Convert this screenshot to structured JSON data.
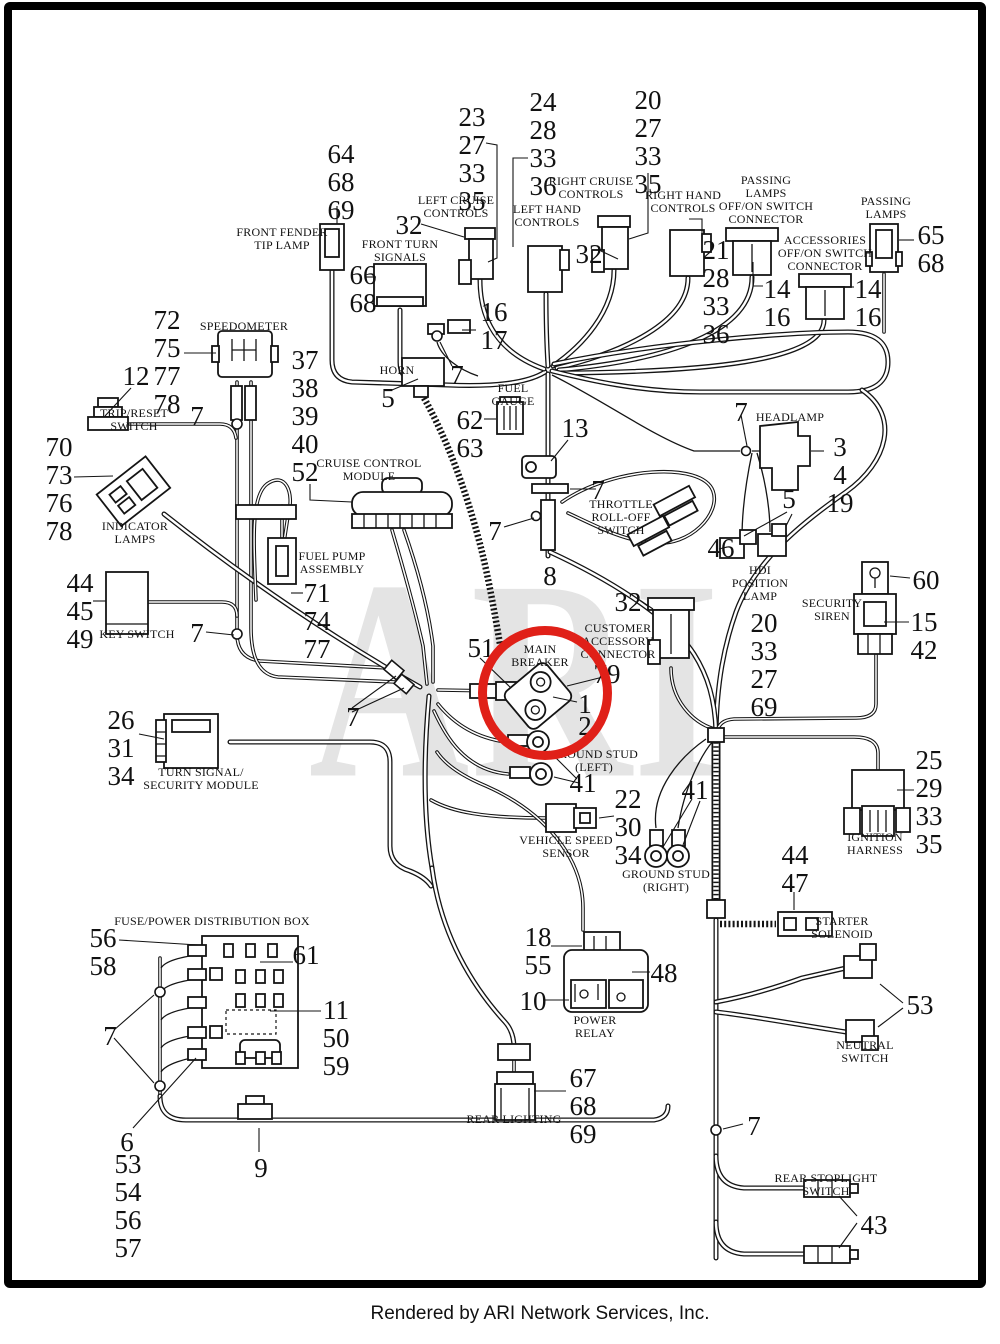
{
  "page": {
    "watermark": "ARI",
    "footer_credit": "Rendered by ARI Network Services, Inc.",
    "highlight_color": "#e02018",
    "line_color": "#141414"
  },
  "labels": {
    "front_fender_tip_lamp": "FRONT FENDER\nTIP LAMP",
    "front_turn_signals": "FRONT TURN\nSIGNALS",
    "left_cruise_controls": "LEFT CRUISE\nCONTROLS",
    "left_hand_controls": "LEFT HAND\nCONTROLS",
    "right_cruise_controls": "RIGHT CRUISE\nCONTROLS",
    "right_hand_controls": "RIGHT HAND\nCONTROLS",
    "passing_lamps_offon_switch_connector": "PASSING\nLAMPS\nOFF/ON SWITCH\nCONNECTOR",
    "accessories_offon_switch_connector": "ACCESSORIES\nOFF/ON SWITCH\nCONNECTOR",
    "passing_lamps": "PASSING\nLAMPS",
    "speedometer": "SPEEDOMETER",
    "trip_reset_switch": "TRIP/RESET\nSWITCH",
    "horn": "HORN",
    "fuel_gauge": "FUEL\nGAUGE",
    "cruise_control_module": "CRUISE CONTROL\nMODULE",
    "throttle_roll_off_switch": "THROTTLE\nROLL-OFF\nSWITCH",
    "headlamp": "HEADLAMP",
    "hdi_position_lamp": "HDI\nPOSITION\nLAMP",
    "security_siren": "SECURITY\nSIREN",
    "key_switch": "KEY SWITCH",
    "indicator_lamps": "INDICATOR\nLAMPS",
    "fuel_pump_assembly": "FUEL PUMP\nASSEMBLY",
    "customer_accessory_connector": "CUSTOMER\nACCESSORY\nCONNECTOR",
    "main_breaker": "MAIN\nBREAKER",
    "ground_stud_left": "GROUND STUD\n(LEFT)",
    "turn_signal_security_module": "TURN SIGNAL/\nSECURITY MODULE",
    "vehicle_speed_sensor": "VEHICLE SPEED\nSENSOR",
    "ground_stud_right": "GROUND STUD\n(RIGHT)",
    "ignition_harness": "IGNITION\nHARNESS",
    "starter_solenoid": "STARTER\nSOLENOID",
    "fuse_power_distribution_box": "FUSE/POWER DISTRIBUTION BOX",
    "power_relay": "POWER\nRELAY",
    "neutral_switch": "NEUTRAL\nSWITCH",
    "rear_lighting": "REAR LIGHTING",
    "rear_stoplight_switch": "REAR STOPLIGHT\nSWITCH"
  },
  "callouts": {
    "front_fender_tip_lamp": "64\n68\n69",
    "left_cruise": "23\n27\n33\n35",
    "left_hand": "24\n28\n33\n36",
    "right_cruise": "20\n27\n33\n35",
    "n32_left_cruise": "32",
    "n32_right_cruise": "32",
    "right_hand": "21\n28\n33\n36",
    "passing_offon": "14\n16",
    "accessories_offon": "14\n16",
    "passing_lamps": "65\n68",
    "front_turn_signals": "66\n68",
    "n16_17": "16\n17",
    "speedometer": "72\n75\n77\n78",
    "n12_trip_reset": "12",
    "n7_trip": "7",
    "speedo_harness": "37\n38\n39\n40\n52",
    "n5_horn": "5",
    "n7_front": "7",
    "fuel_gauge": "62\n63",
    "n13_clip": "13",
    "n7_headlamp": "7",
    "headlamp": "3\n4\n19",
    "indicator_lamps": "70\n73\n76\n78",
    "n5_hdi": "5",
    "n46_hdi": "46",
    "n7_throttle": "7",
    "n7_stem": "7",
    "n8_stem": "8",
    "key_switch": "44\n45\n49",
    "n7_key": "7",
    "n60_siren": "60",
    "siren": "15\n42",
    "n32_cac": "32",
    "cac": "20\n33\n27\n69",
    "n51_breaker": "51",
    "n79_breaker": "79",
    "n1_breaker": "1",
    "n2_breaker": "2",
    "n7_clamps": "7",
    "turn_signal_module": "26\n31\n34",
    "fuel_pump": "71\n74\n77",
    "n41_ground_left": "41",
    "vehicle_speed_sensor": "22\n30\n34",
    "n41_ground_right": "41",
    "ignition_harness": "25\n29\n33\n35",
    "starter_solenoid": "44\n47",
    "fuse_box_a": "56\n58",
    "n61_fuse_box": "61",
    "fuse_box_b": "11\n50\n59",
    "n7_fuse": "7",
    "relay_top": "18\n55",
    "n48_relay": "48",
    "n10_relay": "10",
    "n53_neutral": "53",
    "rear_lighting": "67\n68\n69",
    "n6_fuse": "6",
    "fuse_box_c": "53\n54\n56\n57",
    "n9_bottom": "9",
    "n7_trunk": "7",
    "n43_stoplight": "43"
  }
}
